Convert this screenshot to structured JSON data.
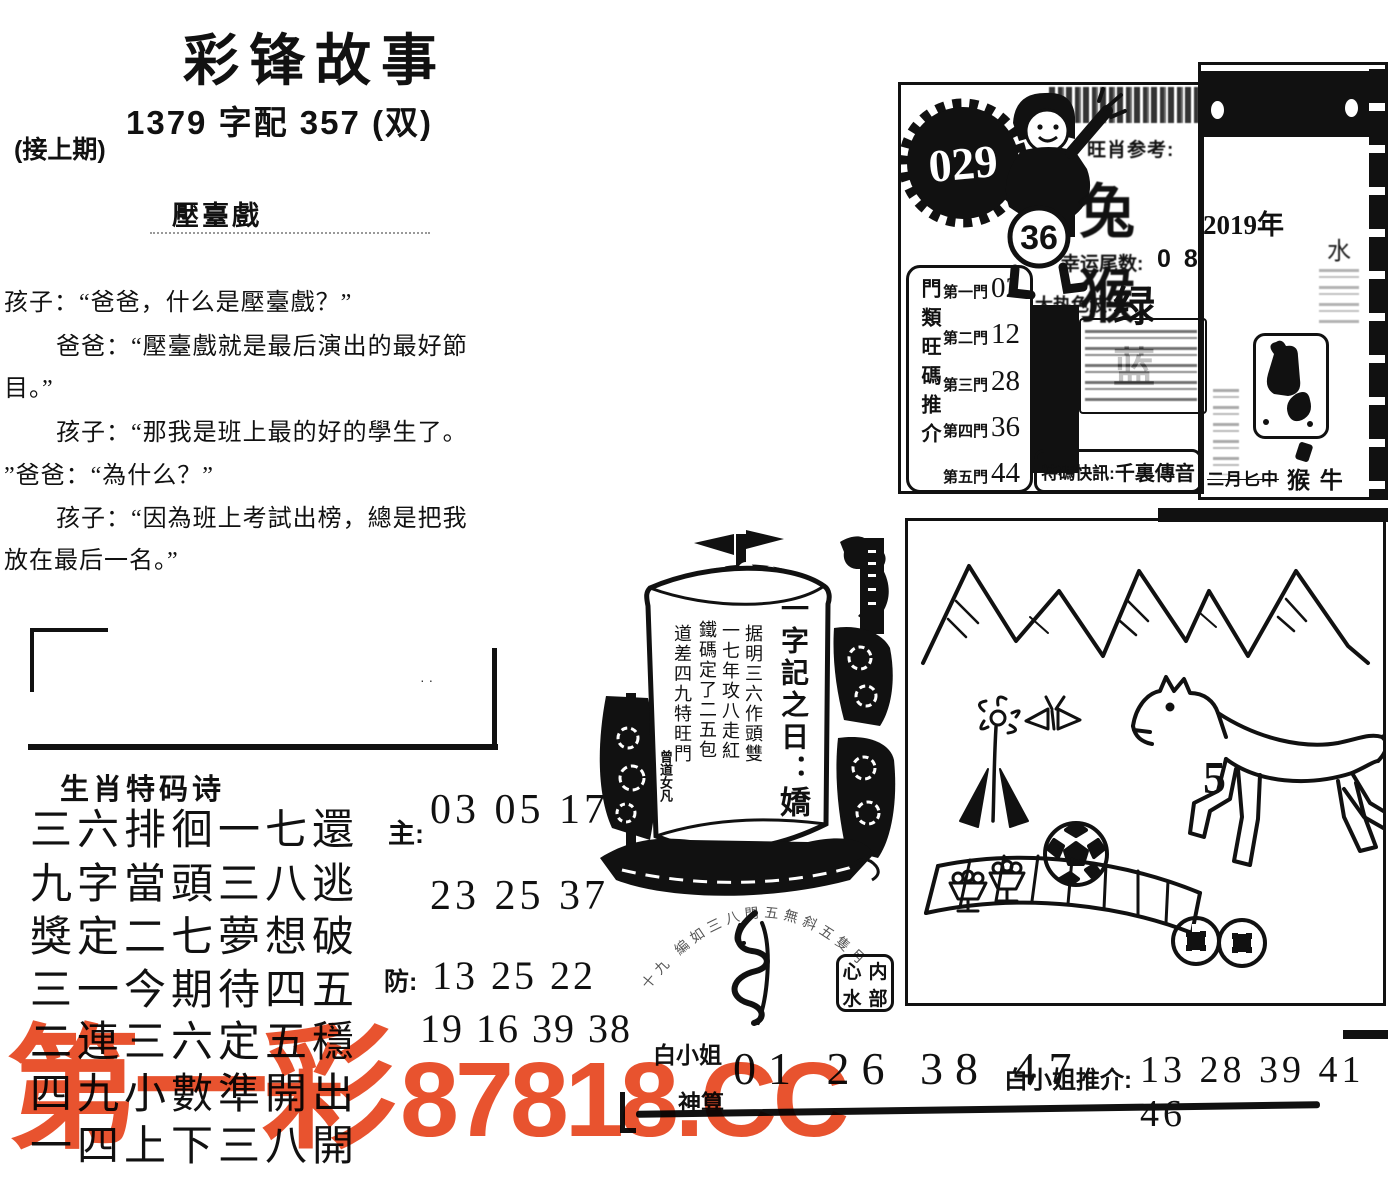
{
  "header": {
    "title": "彩锋故事",
    "subtitle": "1379 字配 357 (双)",
    "continued": "(接上期)",
    "story_title": "壓臺戲"
  },
  "story": {
    "lines": [
      "孩子：“爸爸，什么是壓臺戲？”",
      "爸爸：“壓臺戲就是最后演出的最好節",
      "目。”",
      "孩子：“那我是班上最的好的學生了。",
      "”爸爸：“為什么？”",
      "孩子：“因為班上考試出榜，總是把我",
      "放在最后一名。”"
    ]
  },
  "poem": {
    "heading": "生肖特码诗",
    "lines": [
      "三六排徊一七還",
      "九字當頭三八逃",
      "獎定二七夢想破",
      "三一今期待四五",
      "二連三六定五穩",
      "四九小數準開出",
      "一四上下三八開"
    ],
    "main_label": "主:",
    "main_numbers_1": "03 05 17",
    "main_numbers_2": "23 25 37",
    "guard_label": "防:",
    "guard_numbers_1": "13 25 22",
    "guard_numbers_2": "19 16 39 38"
  },
  "info": {
    "issue": "029",
    "boy_number": "36",
    "zodiac_label": "旺肖参考:",
    "zodiac_value": "兔猴",
    "tail_label": "幸运尾数:",
    "tail_value": "0 8",
    "wave_label": "大热色波:",
    "wave_value": "绿 蓝",
    "gate_panel_label": "門類旺碼推介",
    "gates": [
      {
        "label": "第一門",
        "value": "02"
      },
      {
        "label": "第二門",
        "value": "12"
      },
      {
        "label": "第三門",
        "value": "28"
      },
      {
        "label": "第四門",
        "value": "36"
      },
      {
        "label": "第五門",
        "value": "44"
      }
    ],
    "flash_label": "特碼快訊:",
    "flash_value": "千裏傳音"
  },
  "calendar": {
    "year": "2019年",
    "mark": "水",
    "bottom_left": "二月匕中",
    "bottom_right": "猴 牛"
  },
  "boat": {
    "scroll_title": "一字記之日：",
    "big_char": "嬌",
    "columns": [
      "据明三六作頭雙",
      "一七年攻八走紅",
      "鐵碼定了二五包",
      "道差四九特旺門"
    ],
    "seal": "曾道女凡",
    "arc_text": "十九 編如三八門五無斜五隻月",
    "stamp": {
      "tl": "心",
      "tr": "内",
      "bl": "水",
      "br": "部"
    }
  },
  "illustration": {
    "horse_number": "5"
  },
  "bottom": {
    "lady_label": "白小姐",
    "god_label": "神算",
    "numbers": "01 26 38 47",
    "recommend_label": "白小姐推介:",
    "recommend_numbers": "13 28 39 41 46"
  },
  "watermark": {
    "part1": "第一彩",
    "part2": "87818.CC",
    "color": "#e8532f"
  }
}
